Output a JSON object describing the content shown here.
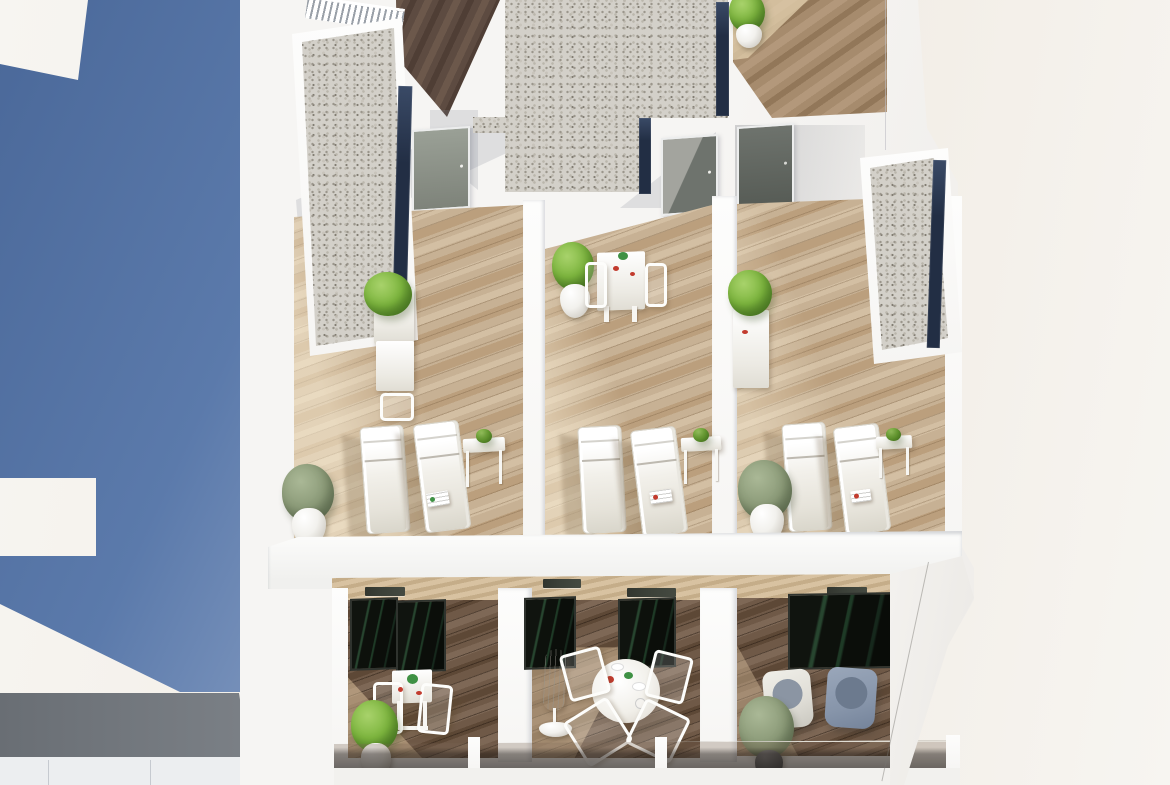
{
  "scene": {
    "title": "Aerial 3D rendering of white apartment building",
    "description": "Photoreal aerial CGI render of a modern white residential building: rooftop solarium terraces with pairs of white sun loungers, bistro sets and potted shrubs; white-gravel roof sections edged with dark solar strips; a timber walkway with slatted railing; below, three furnished balconies (dining set, round table with parasol, two lounge armchairs) behind smoked-glass balustrades. A deep blue shadow is cast across the white ground on the left."
  },
  "colors": {
    "bg_a": "#f7f5f1",
    "bg_b": "#f1ece4",
    "shadow_blue": "#5b7aab",
    "shadow_blue_deep": "#4a6899",
    "shadow_blue_light": "#8ba1c5",
    "wall": "#f6f5f3",
    "wall_bright": "#fdfdfc",
    "wall_shade": "#e6e6e7",
    "wall_shade_dark": "#d2d4d7",
    "grey_roof": "#7b8086",
    "grey_roof_dark": "#696e74",
    "glass_a": "#dde3ec",
    "glass_b": "#8fa4c2",
    "glass_edge": "#2b3a52",
    "gravel": "#d3d0c9",
    "gravel_s1": "#9b968c",
    "gravel_s2": "#bab6ac",
    "gravel_s3": "#827d73",
    "gravel_s4": "#c8c4bb",
    "navy": "#222e44",
    "navy_hi": "#3a4a66",
    "terrace_wood": "#c7b194",
    "terrace_wood_a": "#bb9f7d",
    "terrace_wood_b": "#d3bfa3",
    "dark_wood": "#6f5947",
    "dark_wood_a": "#7e6856",
    "dark_wood_b": "#5d4836",
    "corridor_wood": "#5d4b41",
    "corridor_wood_a": "#6c584b",
    "corridor_wood_b": "#4f3e35",
    "mid_wood": "#a68b6d",
    "mid_wood_a": "#b3987b",
    "mid_wood_b": "#927759",
    "mid_wood_sun": "#e2cfae",
    "soffit_wood": "#d8c2a1",
    "soffit_wood_b": "#c5ad89",
    "door": "#9aa096",
    "door_dark": "#7e837a",
    "door_shadowed": "#6e736d",
    "door_dark2": "#565b55",
    "frame": "#eceded",
    "glassdoor_a": "#10140f",
    "glassdoor_b": "#27452f",
    "white_furniture": "#fdfdfb",
    "plant": "#7eb63f",
    "plant_dark": "#55842a",
    "plant_light": "#a8d26b",
    "olive": "#8c9b79",
    "olive_dark": "#64735a",
    "olive_light": "#aab896",
    "pot_white": "#f2f1ed",
    "pot_rim": "#d6d3cc",
    "pot_grey": "#a7a8a3",
    "pot_dark": "#55585b",
    "red_item": "#c23b2e",
    "green_item": "#3f9144",
    "armchair_light": "#dfddd6",
    "armchair_blue": "#8795aa",
    "cushion_grey": "#8b95a3",
    "cushion_blue": "#6c7a8e",
    "vent": "#3b4038",
    "tint_glass_top": "rgba(122,101,82,0.30)",
    "tint_glass_mid": "rgba(52,43,36,0.58)",
    "tint_glass_bot": "rgba(30,25,21,0.68)",
    "rail_hi": "rgba(242,238,230,0.9)",
    "shadow_warm": "rgba(96,76,48,0.24)",
    "shadow_wall": "rgba(136,142,156,0.22)",
    "sun_warm": "rgba(255,244,220,0.5)"
  },
  "objects": {
    "rooftop_terraces": [
      {
        "name": "left-terrace",
        "furniture": [
          "planter-box-shrub",
          "bistro-table",
          "stool",
          "sun-lounger",
          "sun-lounger",
          "side-table-with-plant",
          "potted-shrub",
          "magazine"
        ]
      },
      {
        "name": "middle-terrace",
        "furniture": [
          "potted-shrub",
          "bistro-table",
          "chair",
          "chair",
          "sun-lounger",
          "sun-lounger",
          "side-table-with-plant",
          "magazine"
        ]
      },
      {
        "name": "right-terrace",
        "furniture": [
          "planter-stand-shrub",
          "sun-lounger",
          "sun-lounger",
          "side-table-with-plant",
          "potted-shrub",
          "magazine"
        ]
      }
    ],
    "balconies": [
      {
        "name": "left-balcony",
        "furniture": [
          "square-dining-table",
          "chair",
          "chair",
          "potted-shrub"
        ]
      },
      {
        "name": "middle-balcony",
        "furniture": [
          "round-table",
          "chair",
          "chair",
          "chair",
          "chair",
          "closed-parasol"
        ]
      },
      {
        "name": "right-balcony",
        "furniture": [
          "lounge-armchair",
          "lounge-armchair",
          "potted-plant"
        ]
      }
    ],
    "roof_features": [
      "gravel-roof-left",
      "gravel-roof-center",
      "gravel-roof-right",
      "solar-edge-strips",
      "timber-walkway",
      "walkway-railing",
      "entry-door",
      "entry-door",
      "entry-door"
    ],
    "environment": [
      "blue-cast-shadow",
      "lower-roof-slab",
      "side-glass-balustrade"
    ]
  }
}
